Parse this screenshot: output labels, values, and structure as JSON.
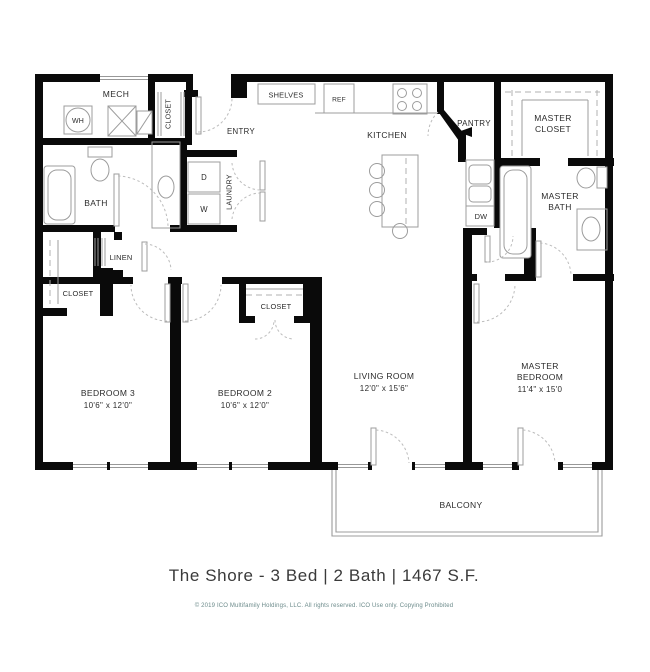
{
  "meta": {
    "title": "The Shore - 3 Bed | 2 Bath | 1467 S.F.",
    "copyright": "© 2019 ICO Multifamily Holdings, LLC. All rights reserved.  ICO Use only.  Copying Prohibited"
  },
  "rooms": {
    "mech": {
      "label": "MECH"
    },
    "entry": {
      "label": "ENTRY"
    },
    "entry_closet": {
      "label": "CLOSET"
    },
    "shelves": {
      "label": "SHELVES"
    },
    "kitchen": {
      "label": "KITCHEN"
    },
    "pantry": {
      "label": "PANTRY"
    },
    "master_closet": {
      "lines": [
        "MASTER",
        "CLOSET"
      ]
    },
    "master_bath": {
      "lines": [
        "MASTER",
        "BATH"
      ]
    },
    "bath": {
      "label": "BATH"
    },
    "laundry": {
      "label": "LAUNDRY"
    },
    "linen": {
      "label": "LINEN"
    },
    "closet_bed3": {
      "label": "CLOSET"
    },
    "closet_bed2": {
      "label": "CLOSET"
    },
    "bedroom3": {
      "label": "BEDROOM 3",
      "dims": "10'6\" x 12'0\""
    },
    "bedroom2": {
      "label": "BEDROOM 2",
      "dims": "10'6\" x 12'0\""
    },
    "living": {
      "label": "LIVING ROOM",
      "dims": "12'0\" x 15'6\""
    },
    "master_bedroom": {
      "lines": [
        "MASTER",
        "BEDROOM"
      ],
      "dims": "11'4\" x 15'0"
    },
    "balcony": {
      "label": "BALCONY"
    }
  },
  "fixtures": {
    "water_heater": "WH",
    "dryer": "D",
    "washer": "W",
    "dishwasher": "DW",
    "fridge": "REF"
  },
  "colors": {
    "wall": "#0a0a0a",
    "fixture_stroke": "#9c9c9c",
    "text": "#2b2b2b",
    "copyright_text": "#6b8a8a"
  }
}
